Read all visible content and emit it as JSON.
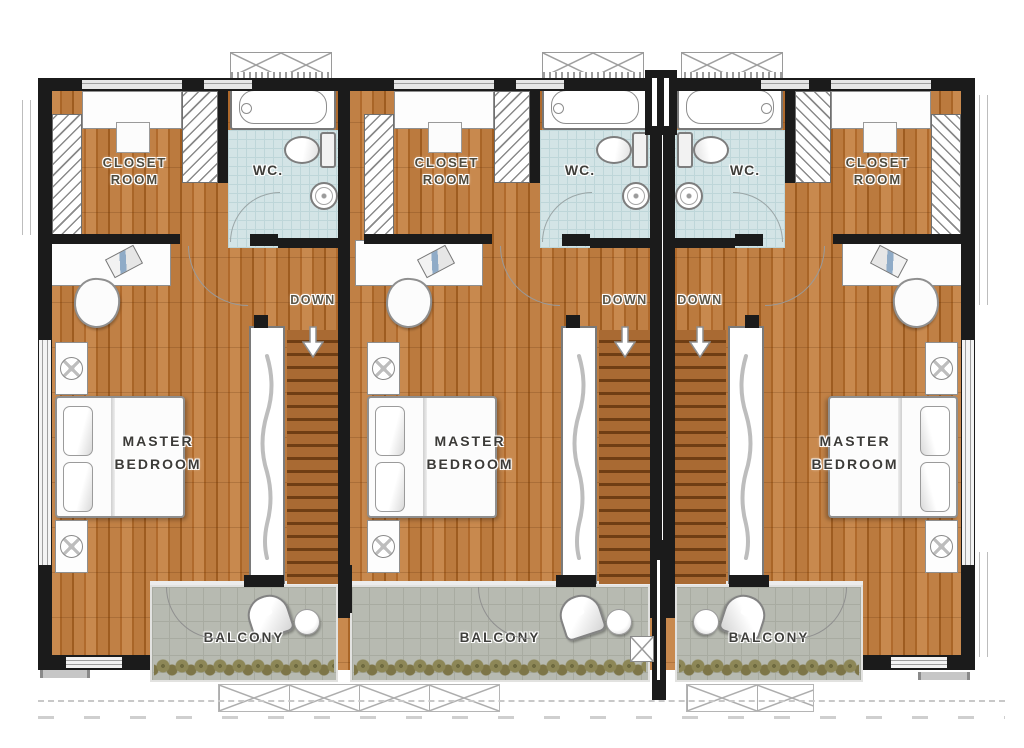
{
  "units": [
    {
      "closet_line1": "CLOSET",
      "closet_line2": "ROOM",
      "wc_label": "WC.",
      "down_label": "DOWN",
      "bedroom_line1": "MASTER",
      "bedroom_line2": "BEDROOM",
      "balcony_label": "BALCONY"
    },
    {
      "closet_line1": "CLOSET",
      "closet_line2": "ROOM",
      "wc_label": "WC.",
      "down_label": "DOWN",
      "bedroom_line1": "MASTER",
      "bedroom_line2": "BEDROOM",
      "balcony_label": "BALCONY"
    },
    {
      "closet_line1": "CLOSET",
      "closet_line2": "ROOM",
      "wc_label": "WC.",
      "down_label": "DOWN",
      "bedroom_line1": "MASTER",
      "bedroom_line2": "BEDROOM",
      "balcony_label": "BALCONY"
    }
  ],
  "colors": {
    "wood_floor": "#b8763a",
    "wall": "#1b1b1b",
    "wc_tile": "#d3e4e6",
    "balcony_floor": "#b7bab1",
    "stair_tread": "#6f3e14",
    "plant": "#8d8757",
    "label_text": "#46443c"
  }
}
